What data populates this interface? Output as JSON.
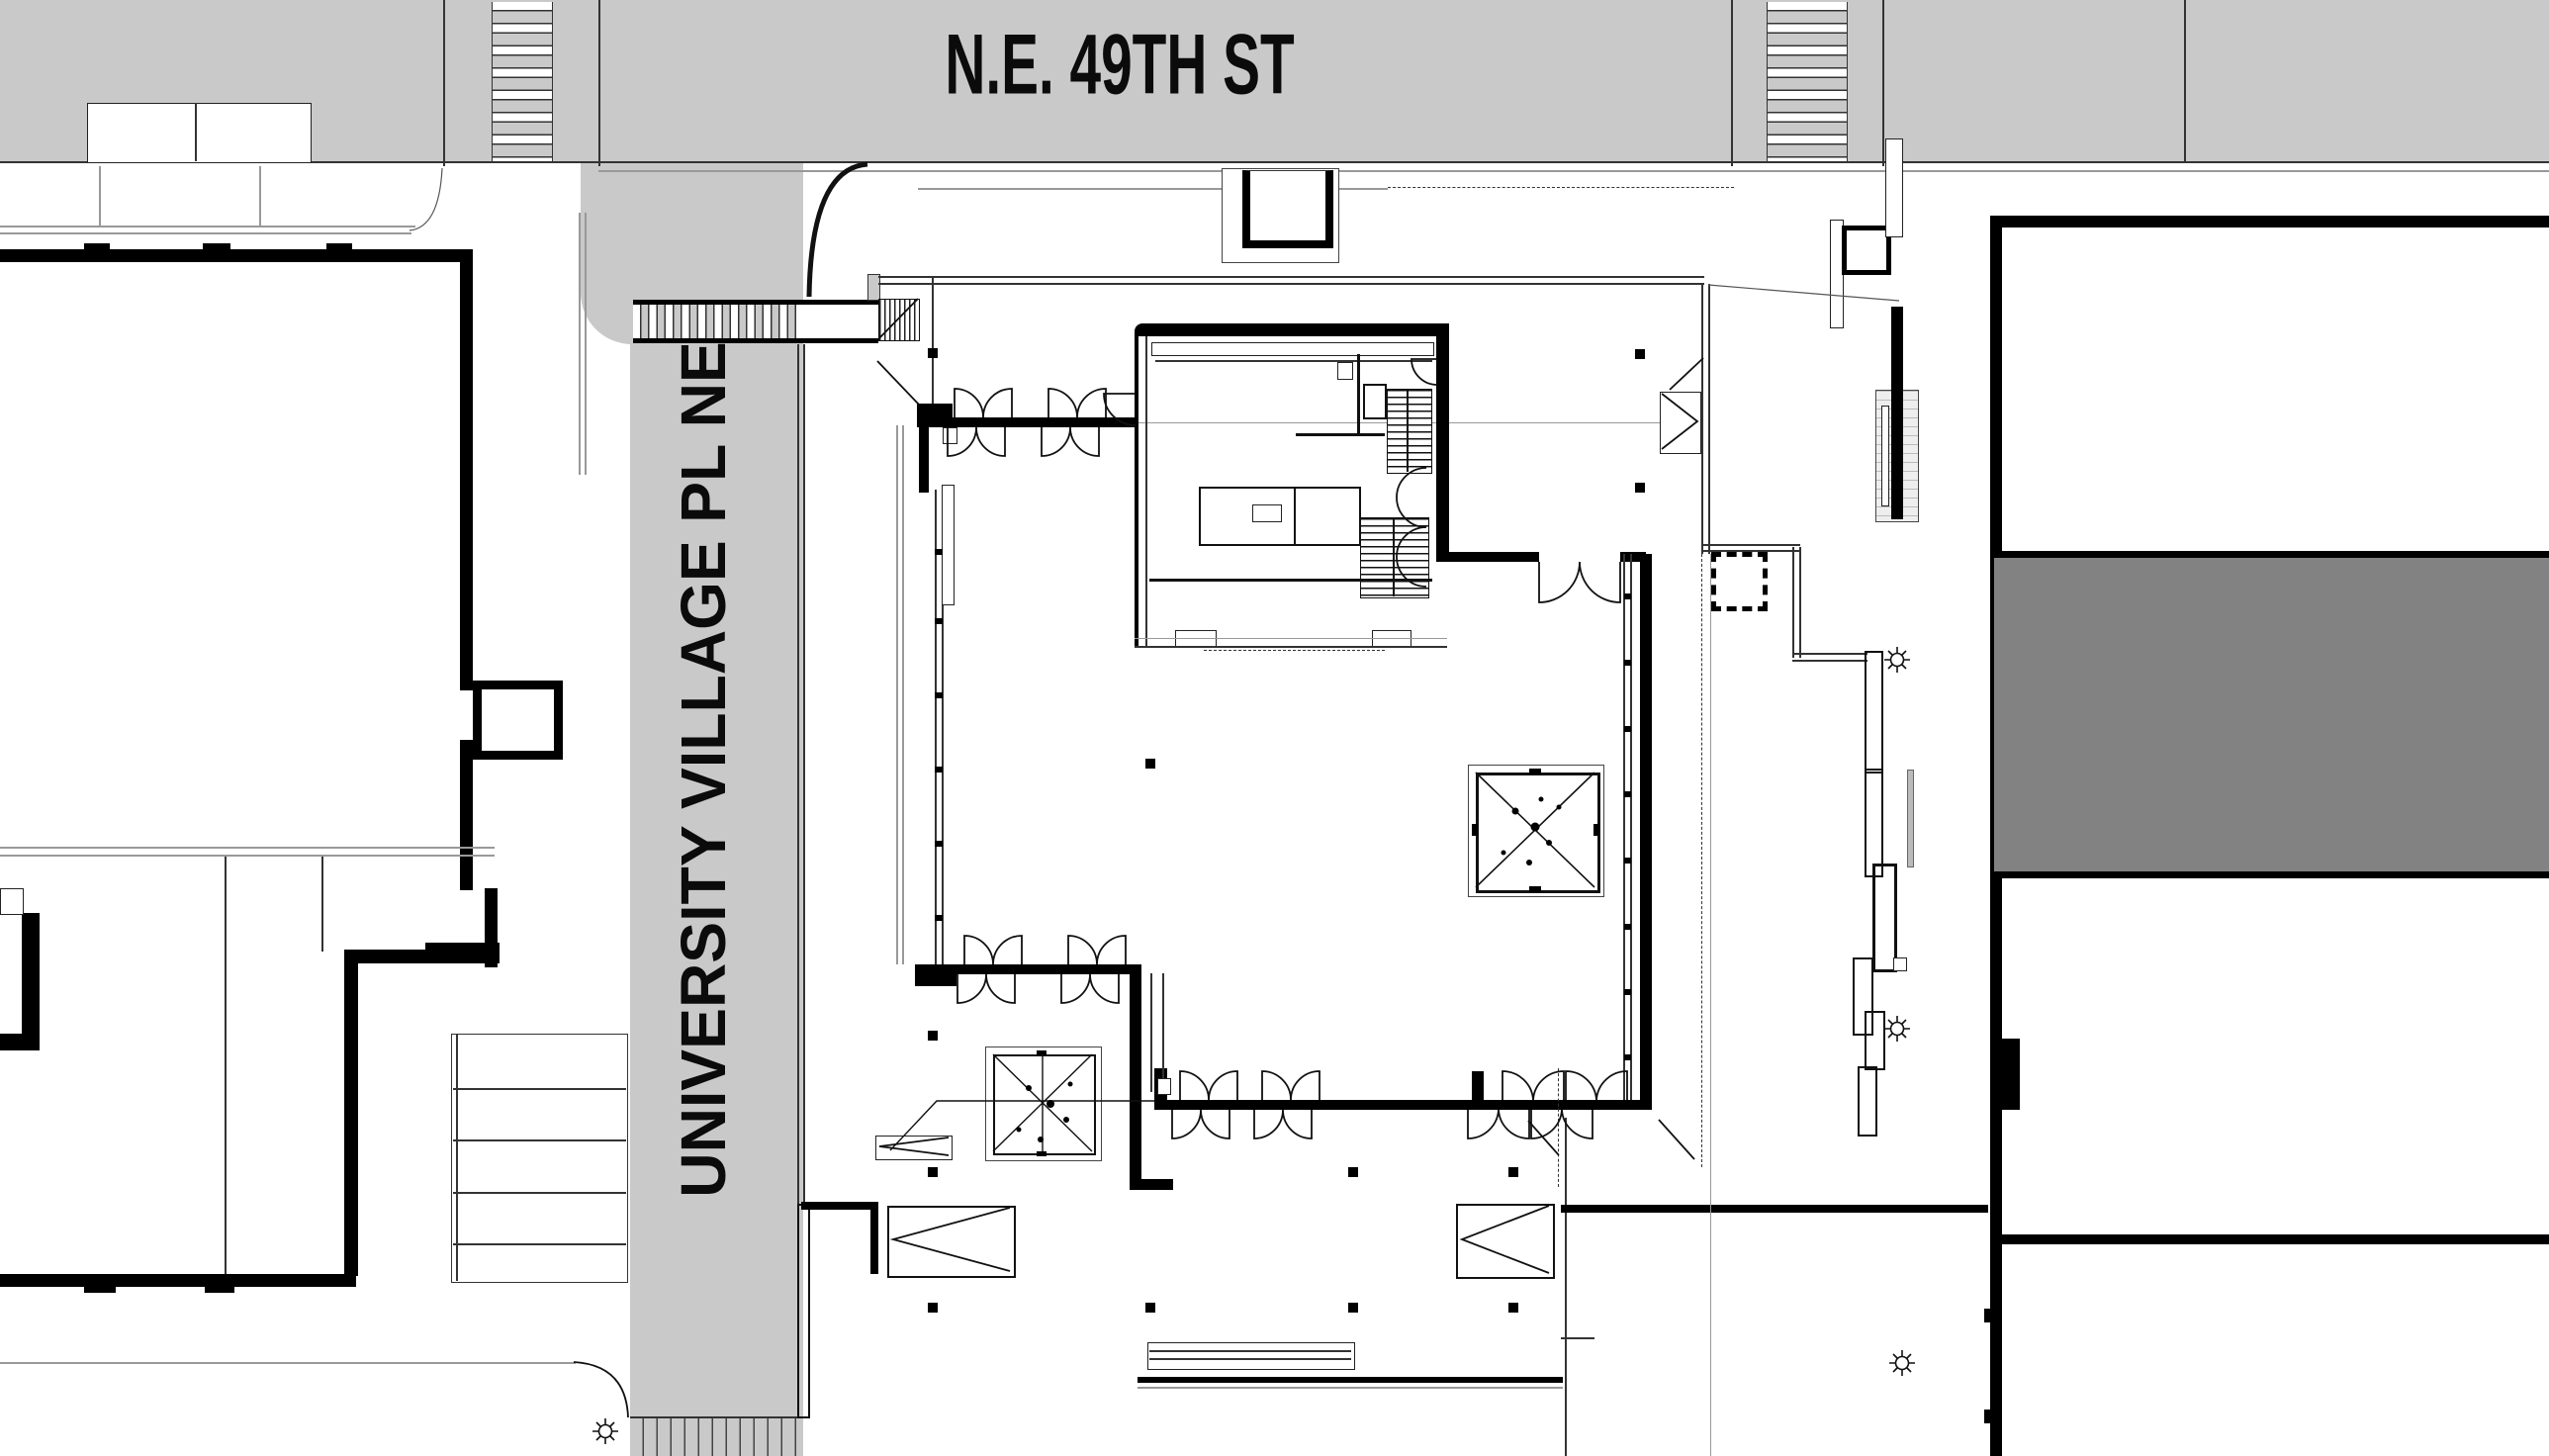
{
  "title": "architectural site plan",
  "streets": {
    "horizontal_label": "N.E. 49TH ST",
    "vertical_label": "UNIVERSITY VILLAGE PL NE"
  },
  "colors": {
    "street_gray": "#c9c9c9",
    "roof_gray": "#828282",
    "line_dark": "#111111"
  },
  "symbols": {
    "crosswalks": 4,
    "streetlight_icons": 4,
    "skylight_boxes": 2,
    "stair_runs": 2,
    "ramp_arrows": 4
  }
}
